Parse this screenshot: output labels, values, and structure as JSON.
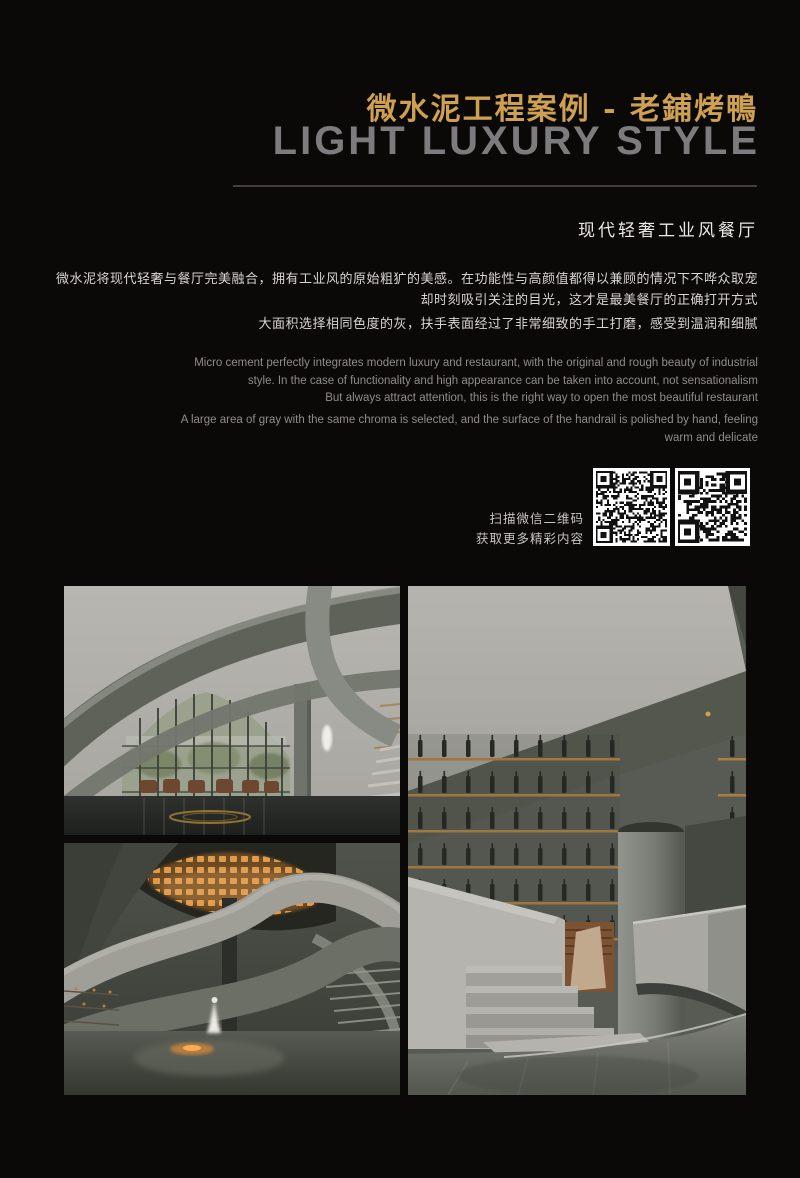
{
  "colors": {
    "background": "#0b0808",
    "accent_gold": "#cda052",
    "headline_gray": "#7c7c7f",
    "amber_shelf": "#b5813f",
    "orange_installation": "#e09a4a"
  },
  "header": {
    "title_cn": "微水泥工程案例 - 老鋪烤鴨",
    "title_en": "LIGHT LUXURY STYLE"
  },
  "intro": {
    "subtitle": "现代轻奢工业风餐厅",
    "cn_lines": [
      "微水泥将现代轻奢与餐厅完美融合，拥有工业风的原始粗犷的美感。在功能性与高颜值都得以兼顾的情况下不哗众取宠",
      "却时刻吸引关注的目光，这才是最美餐厅的正确打开方式",
      "大面积选择相同色度的灰，扶手表面经过了非常细致的手工打磨，感受到温润和细腻"
    ],
    "en_lines_1": [
      "Micro cement perfectly integrates modern luxury and restaurant, with the original and rough beauty of industrial",
      "style. In the case of functionality and high appearance can be taken into account, not sensationalism",
      "But always attract attention, this is the right way to open the most beautiful restaurant"
    ],
    "en_lines_2": [
      "A large area of gray with the same chroma is selected, and the surface of the handrail is polished by hand, feeling",
      "warm and delicate"
    ]
  },
  "qr": {
    "caption_line1": "扫描微信二维码",
    "caption_line2": "获取更多精彩内容",
    "code_names": [
      "wechat-qr-code-left",
      "wechat-qr-code-right"
    ]
  }
}
